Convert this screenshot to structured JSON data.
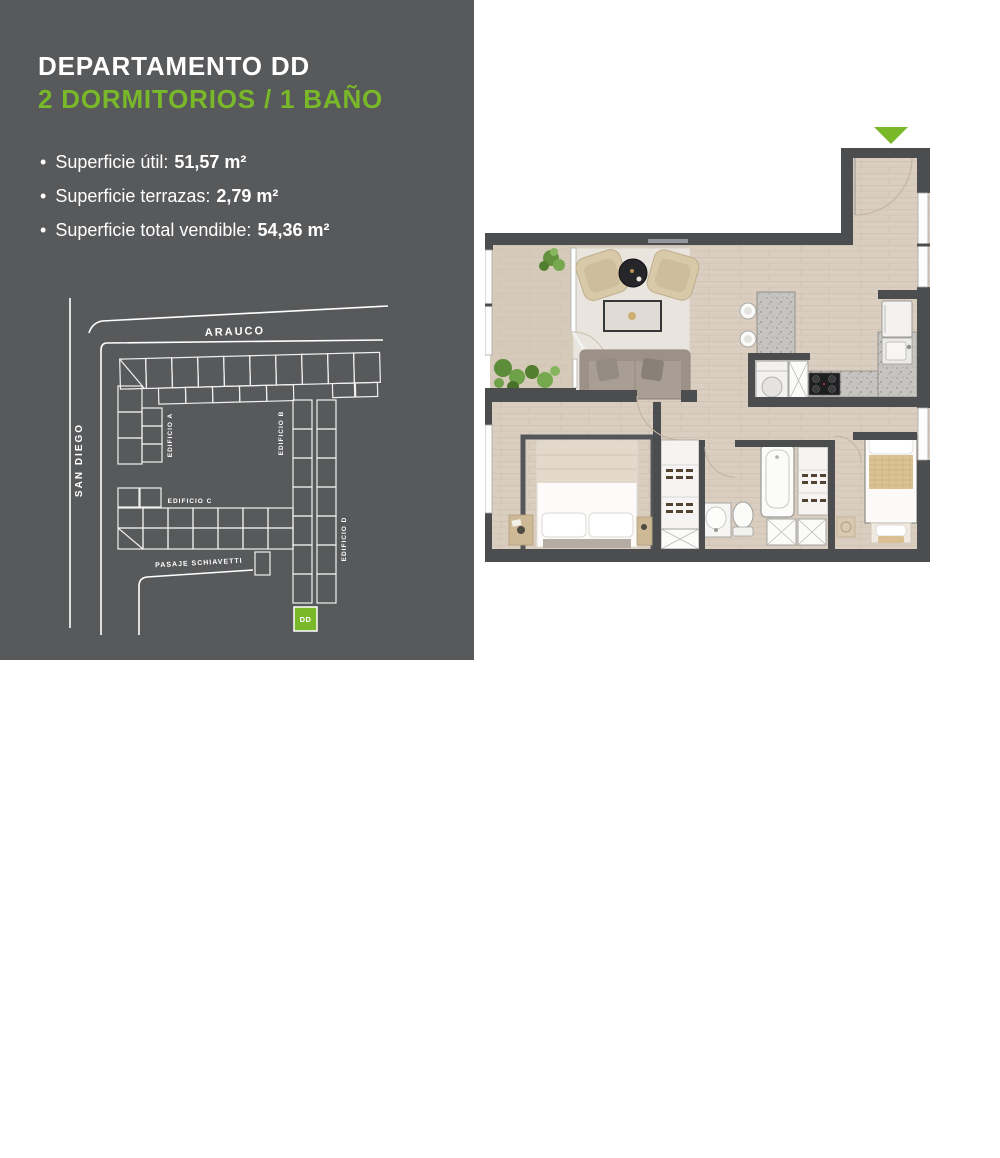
{
  "panel": {
    "background": "#58595b",
    "accent": "#79b829",
    "title": "DEPARTAMENTO DD",
    "subtitle": "2 DORMITORIOS / 1 BAÑO",
    "bullet_char": "•",
    "bullets": [
      {
        "label": "Superficie útil:",
        "value": "51,57 m²"
      },
      {
        "label": "Superficie terrazas:",
        "value": "2,79 m²"
      },
      {
        "label": "Superficie total vendible:",
        "value": "54,36 m²"
      }
    ]
  },
  "site_map": {
    "street_top": "ARAUCO",
    "street_left": "SAN DIEGO",
    "street_bottom": "PASAJE SCHIAVETTI",
    "building_a": "EDIFICIO A",
    "building_b": "EDIFICIO B",
    "building_c": "EDIFICIO C",
    "building_d": "EDIFICIO D",
    "unit_marker": "DD",
    "marker_color": "#79b829",
    "line_color": "#ffffff"
  },
  "floor_plan": {
    "entry_marker_color": "#79b829",
    "wall_color": "#4c4d4f",
    "floor_color": "#d9cec0"
  }
}
